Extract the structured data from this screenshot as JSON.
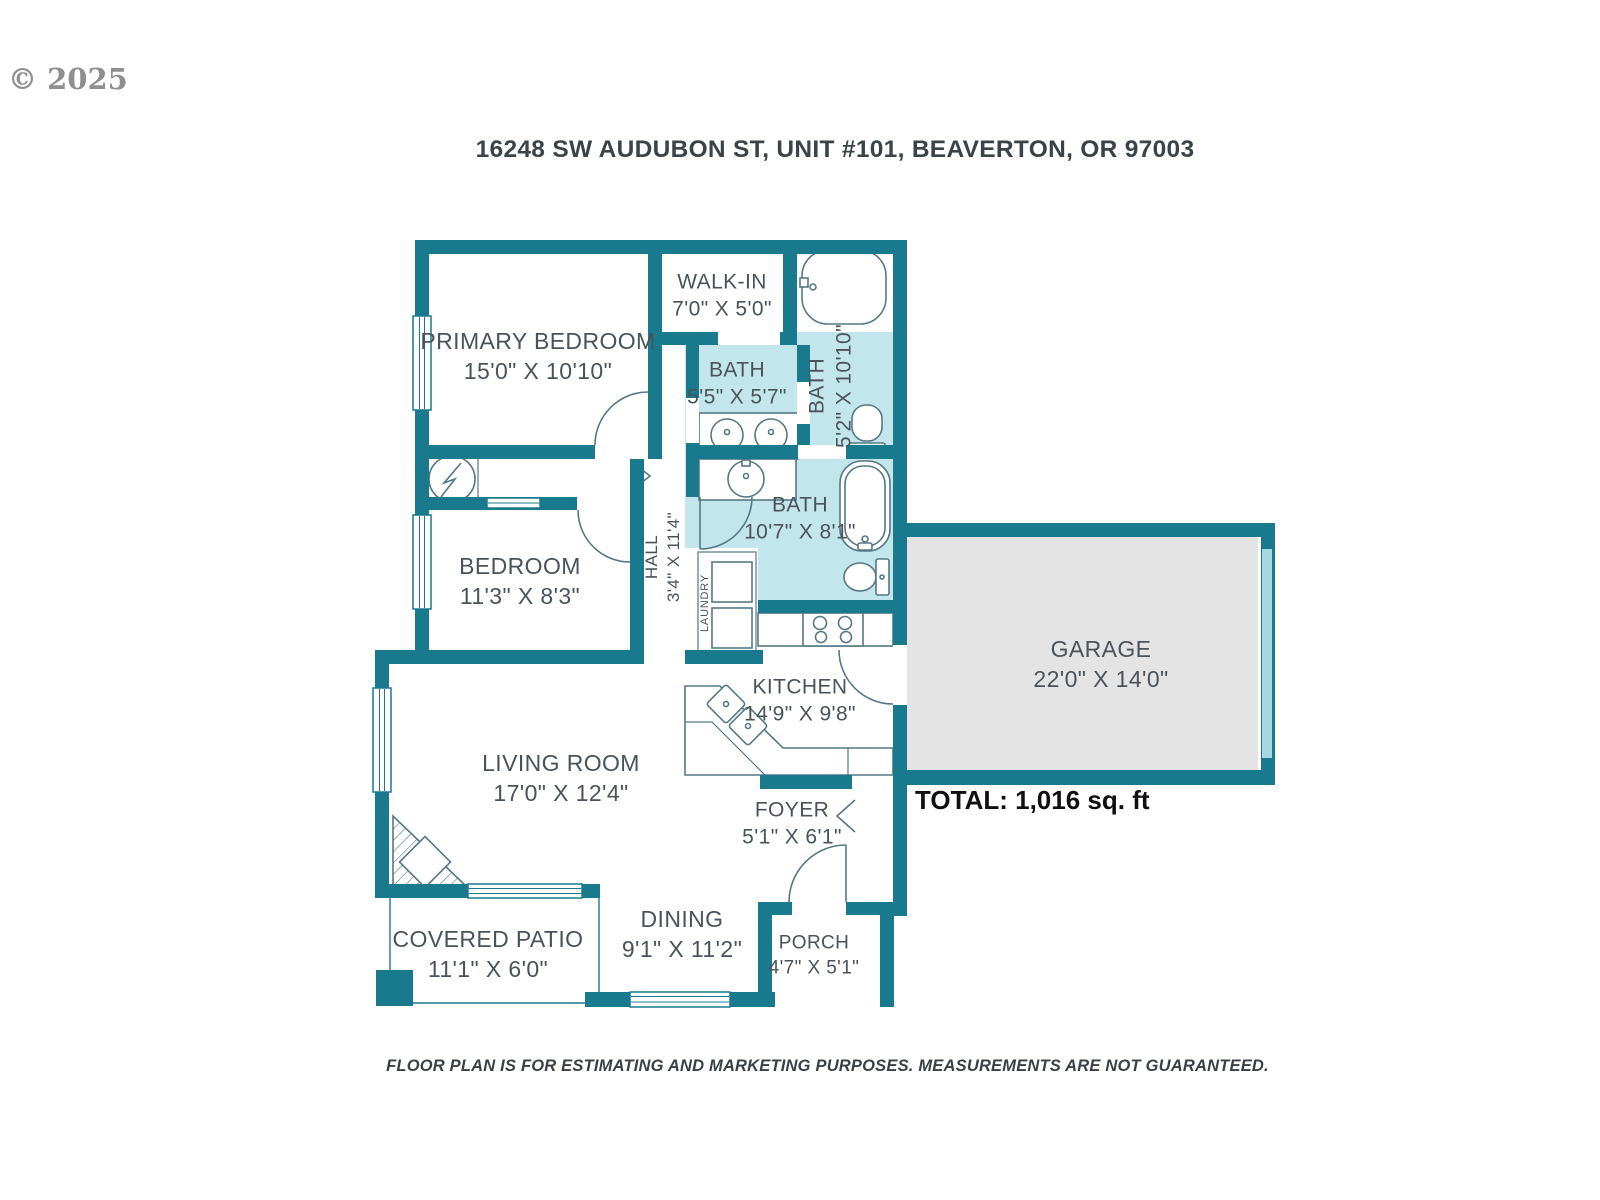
{
  "watermark": "© 2025",
  "header": {
    "address": "16248 SW AUDUBON ST, UNIT #101, BEAVERTON, OR 97003"
  },
  "plan": {
    "total": "TOTAL: 1,016 sq. ft",
    "rooms": {
      "primary_bedroom": {
        "name": "PRIMARY BEDROOM",
        "dims": "15'0\" X 10'10\""
      },
      "walk_in": {
        "name": "WALK-IN",
        "dims": "7'0\" X 5'0\""
      },
      "bath_top": {
        "name": "BATH",
        "dims": "5'5\" X 5'7\""
      },
      "bath_right": {
        "name": "BATH",
        "dims": "5'2\" X 10'10\""
      },
      "bath_main": {
        "name": "BATH",
        "dims": "10'7\" X 8'1\""
      },
      "hall": {
        "name": "HALL",
        "dims": "3'4\" X 11'4\""
      },
      "bedroom": {
        "name": "BEDROOM",
        "dims": "11'3\" X 8'3\""
      },
      "laundry": {
        "name": "LAUNDRY"
      },
      "kitchen": {
        "name": "KITCHEN",
        "dims": "14'9\" X 9'8\""
      },
      "garage": {
        "name": "GARAGE",
        "dims": "22'0\" X 14'0\""
      },
      "living_room": {
        "name": "LIVING ROOM",
        "dims": "17'0\" X 12'4\""
      },
      "foyer": {
        "name": "FOYER",
        "dims": "5'1\" X 6'1\""
      },
      "dining": {
        "name": "DINING",
        "dims": "9'1\" X 11'2\""
      },
      "covered_patio": {
        "name": "COVERED PATIO",
        "dims": "11'1\" X 6'0\""
      },
      "porch": {
        "name": "PORCH",
        "dims": "4'7\" X 5'1\""
      }
    }
  },
  "footer": {
    "disclaimer": "FLOOR PLAN IS FOR ESTIMATING AND MARKETING PURPOSES. MEASUREMENTS ARE NOT GUARANTEED."
  },
  "colors": {
    "wall": "#19798d",
    "bath_fill": "#c3e6ed",
    "garage_fill": "#e4e4e4",
    "garage_door": "#a7d7e1",
    "fixture_line": "#557885",
    "label_text": "#4b535a"
  }
}
